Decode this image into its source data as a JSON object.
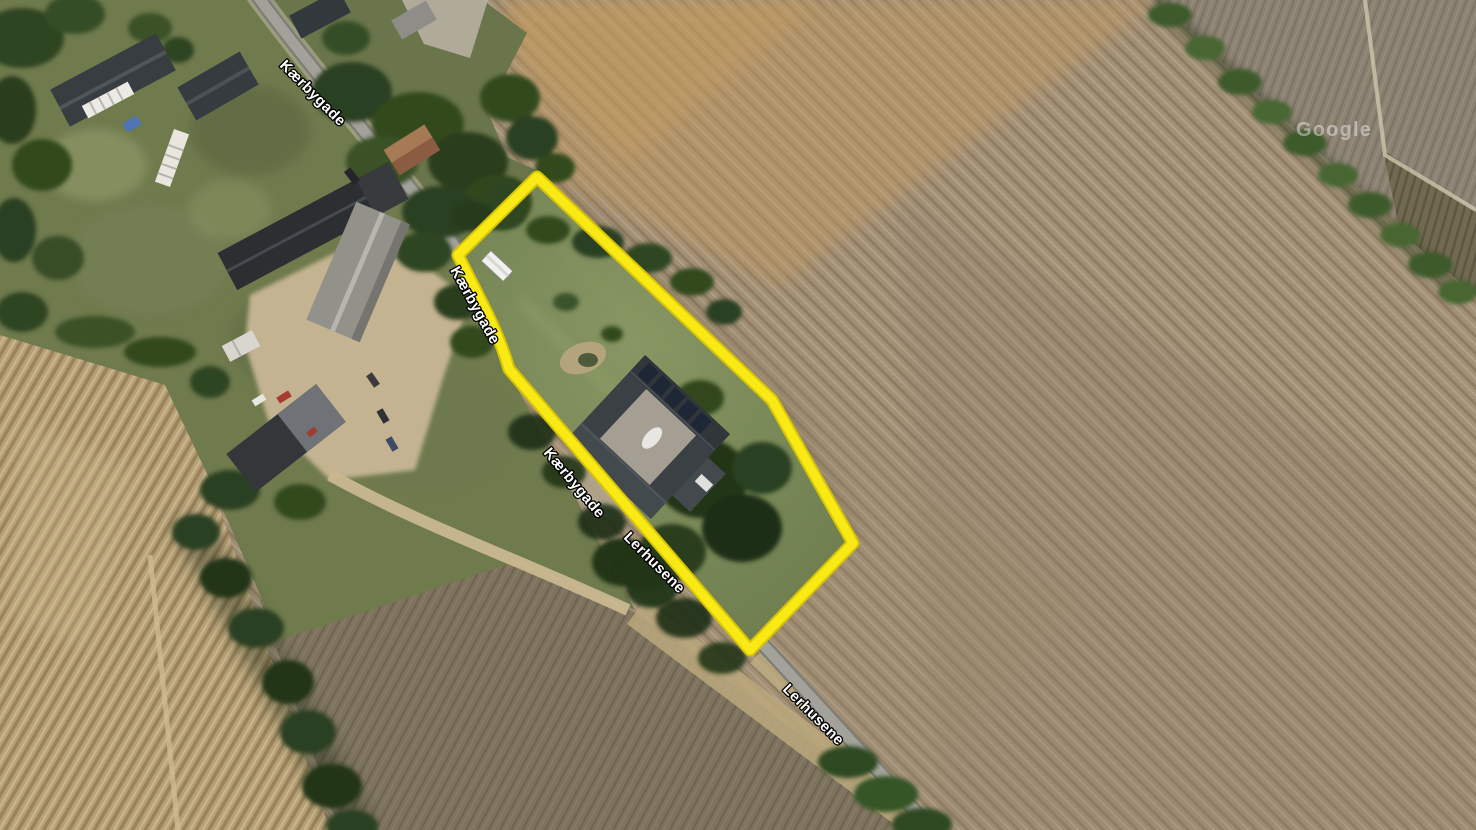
{
  "map": {
    "view": "satellite",
    "roads": [
      {
        "name": "Kærbygade"
      },
      {
        "name": "Lerhusene"
      }
    ]
  },
  "labels": {
    "kaerbygade_top": "Kærbygade",
    "kaerbygade_mid": "Kærbygade",
    "kaerbygade_hidden": "Kærbygade",
    "lerhusene_upper": "Lerhusene",
    "lerhusene_lower": "Lerhusene"
  },
  "watermark": {
    "text": "Google"
  },
  "boundary": {
    "color": "#F9EA16",
    "edge_color": "#D8C404",
    "path": "M537,177 L772,400 L853,543 L750,650 L509,369 C498,330 480,300 458,255 Z"
  }
}
